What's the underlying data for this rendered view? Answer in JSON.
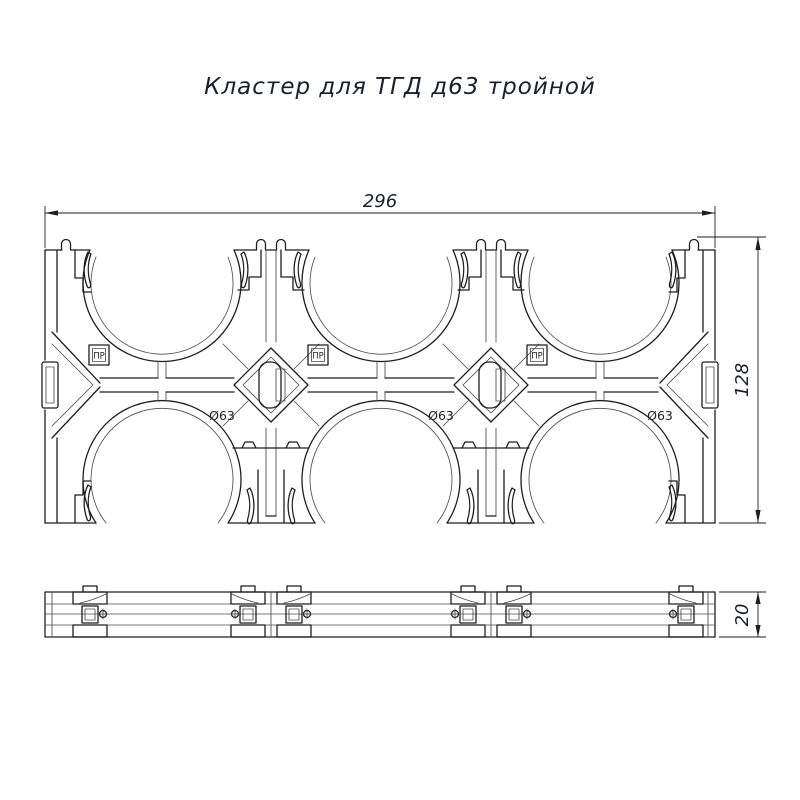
{
  "title": "Кластер для ТГД д63 тройной",
  "dimensions": {
    "overall_width_mm": "296",
    "overall_height_mm": "128",
    "thickness_mm": "20"
  },
  "labels": {
    "tube_diameter": "Ø63",
    "marking": "ПР"
  },
  "colors": {
    "background": "#ffffff",
    "outline": "#1e1e1e",
    "thin_line": "#4d4d4d",
    "title_text": "#1a1f2b"
  }
}
